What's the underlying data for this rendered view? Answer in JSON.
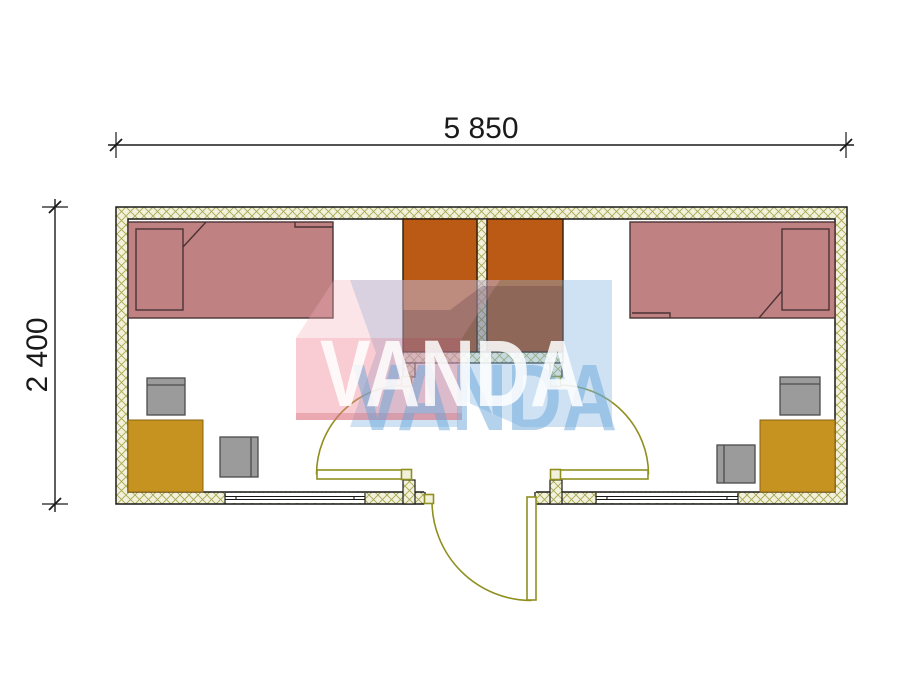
{
  "dimensions": {
    "width_label": "5 850",
    "height_label": "2 400"
  },
  "watermark": {
    "brand": "VANDA"
  },
  "plan": {
    "type": "container-cabin-floor-plan",
    "rooms": [
      "left-room",
      "entry-vestibule",
      "right-room"
    ],
    "furniture": [
      {
        "item": "single-bed",
        "room": "left-room"
      },
      {
        "item": "wardrobe",
        "room": "left-room"
      },
      {
        "item": "desk",
        "room": "left-room"
      },
      {
        "item": "chair",
        "room": "left-room",
        "count": 2
      },
      {
        "item": "single-bed",
        "room": "right-room"
      },
      {
        "item": "wardrobe",
        "room": "right-room"
      },
      {
        "item": "desk",
        "room": "right-room"
      },
      {
        "item": "chair",
        "room": "right-room",
        "count": 2
      }
    ],
    "doors": [
      "exterior-entry-door",
      "left-room-door",
      "right-room-door"
    ],
    "windows": [
      "left-bottom-window",
      "right-bottom-window"
    ]
  },
  "colors": {
    "wall_fill": "#f2f1dc",
    "wall_hatch": "#a9a851",
    "line": "#1a1a1a",
    "bed_fill": "#c08183",
    "bed_line": "#4a3334",
    "wardrobe_fill": "#bb5a15",
    "wardrobe_line": "#2e1a0c",
    "desk_fill": "#c79320",
    "desk_line": "#8a6312",
    "chair_fill": "#9b9b9b",
    "chair_line": "#4c4c4c",
    "door": "#8f8f20",
    "jamb_fill": "#f2f1dc",
    "wm_pink": "rgba(238,128,142,0.40)",
    "wm_pink_top": "rgba(242,175,185,0.33)",
    "wm_pink_edge": "rgba(205,95,110,0.32)",
    "wm_blue": "rgba(125,178,225,0.38)",
    "wm_shadow": "rgba(85,55,65,0.28)",
    "wm_text_white": "rgba(255,255,255,0.85)",
    "wm_text_blue": "rgba(105,165,215,0.50)"
  }
}
